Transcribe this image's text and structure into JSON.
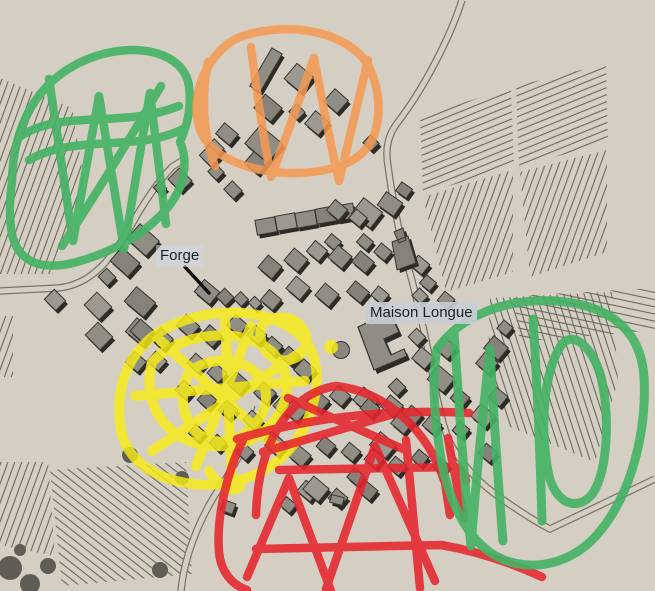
{
  "title": "Annotated village map",
  "labels": {
    "forge": "Forge",
    "maison_longue": "Maison Longue"
  },
  "annotations": [
    {
      "id": "northwest-green-zone",
      "color_name": "green",
      "color": "#44b364"
    },
    {
      "id": "north-orange-zone",
      "color_name": "orange",
      "color": "#f59a52"
    },
    {
      "id": "center-yellow-zone",
      "color_name": "yellow",
      "color": "#f7ec14"
    },
    {
      "id": "south-red-zone",
      "color_name": "red",
      "color": "#e6262e"
    },
    {
      "id": "east-green-zone",
      "color_name": "green",
      "color": "#44b364"
    }
  ],
  "map_colors": {
    "background": "#d5cfc3",
    "building": "#908d85",
    "building_light": "#9c9991",
    "building_dark": "#858279",
    "building_shadow": "#2d2b26",
    "building_outline": "#37352f",
    "road_line": "#7a7567",
    "hatch_line": "#6b675c",
    "tree": "#5f5d55",
    "tree_light": "#8a877f",
    "label_text": "#1c1f26",
    "leader_line": "#111111"
  }
}
